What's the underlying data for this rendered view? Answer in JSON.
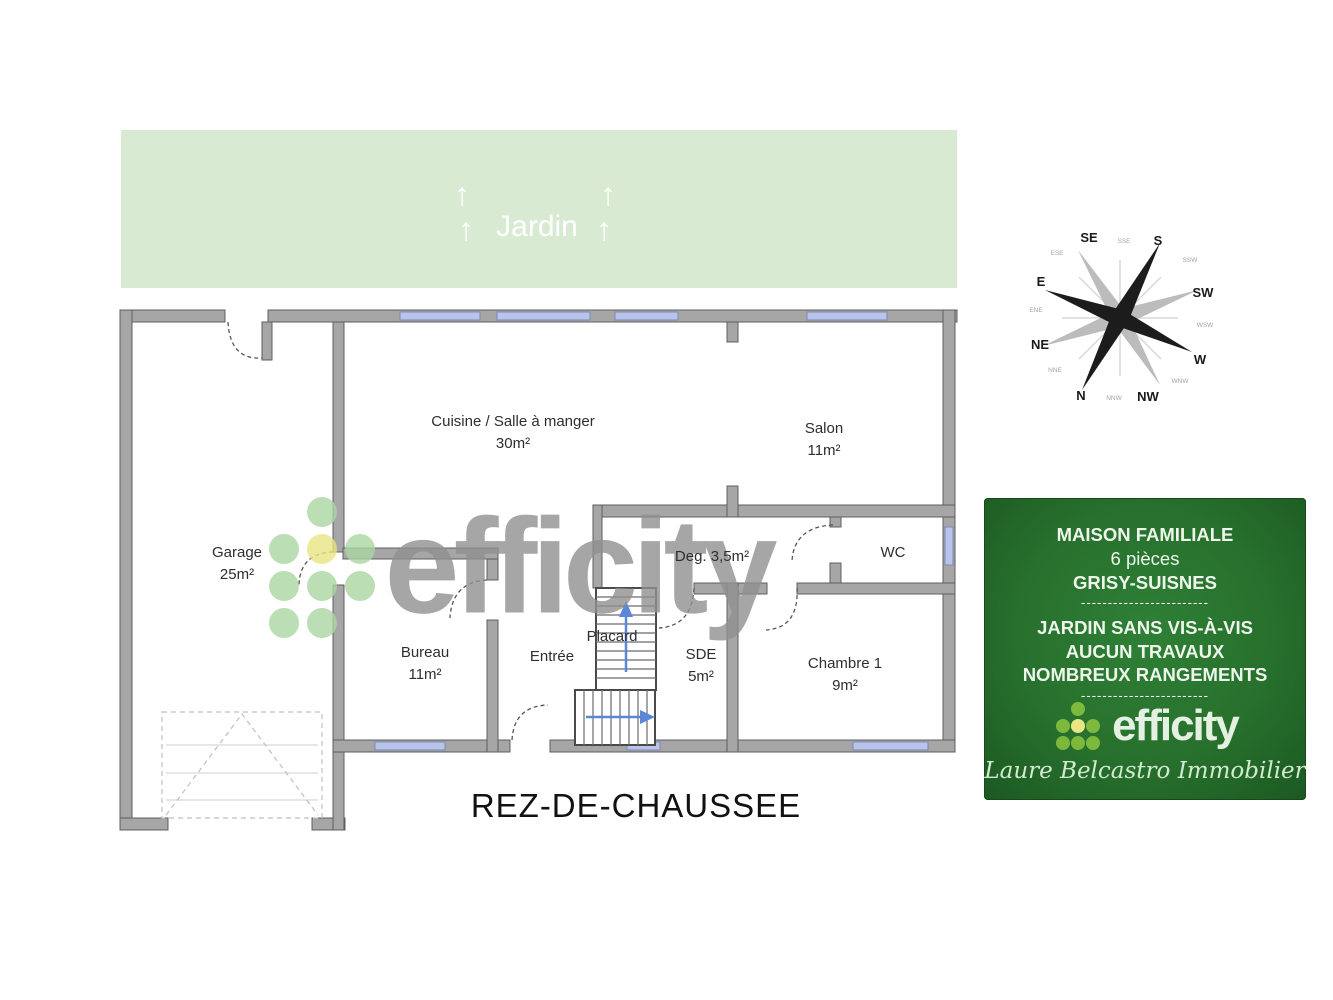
{
  "page": {
    "floor_title": "REZ-DE-CHAUSSEE"
  },
  "garden": {
    "label": "Jardin",
    "arrow_icon": "↑"
  },
  "compass": {
    "cardinal": {
      "n": "N",
      "s": "S",
      "e": "E",
      "w": "W",
      "ne": "NE",
      "nw": "NW",
      "se": "SE",
      "sw": "SW"
    },
    "minor": [
      "NNE",
      "ENE",
      "ESE",
      "SSE",
      "SSW",
      "WSW",
      "WNW",
      "NNW"
    ]
  },
  "rooms": {
    "cuisine": {
      "name": "Cuisine / Salle à manger",
      "area": "30m²"
    },
    "salon": {
      "name": "Salon",
      "area": "11m²"
    },
    "garage": {
      "name": "Garage",
      "area": "25m²"
    },
    "bureau": {
      "name": "Bureau",
      "area": "11m²"
    },
    "entree": {
      "name": "Entrée"
    },
    "degagement": {
      "name": "Deg. 3,5m²"
    },
    "wc": {
      "name": "WC"
    },
    "sde": {
      "name": "SDE",
      "area": "5m²"
    },
    "chambre1": {
      "name": "Chambre 1",
      "area": "9m²"
    },
    "placard": {
      "name": "Placard"
    }
  },
  "watermark": {
    "brand": "efficity"
  },
  "panel": {
    "line1": "MAISON FAMILIALE",
    "line2": "6 pièces",
    "line3": "GRISY-SUISNES",
    "divider": "------------------------",
    "line4": "JARDIN SANS VIS-À-VIS",
    "line5": "AUCUN TRAVAUX",
    "line6": "NOMBREUX RANGEMENTS",
    "brand": "efficity",
    "agent": "Laure Belcastro Immobilier"
  },
  "colors": {
    "garden_bg": "#d8ebd2",
    "wall_gray": "#a6a6a6",
    "window_blue": "#b9c4ea",
    "panel_green": "#27702d",
    "panel_green_dark": "#1c5922",
    "brand_dot_green": "#abd6a3",
    "brand_dot_yellow": "#e9e583",
    "watermark_gray": "#909090",
    "stair_arrow_blue": "#5b87d6"
  }
}
